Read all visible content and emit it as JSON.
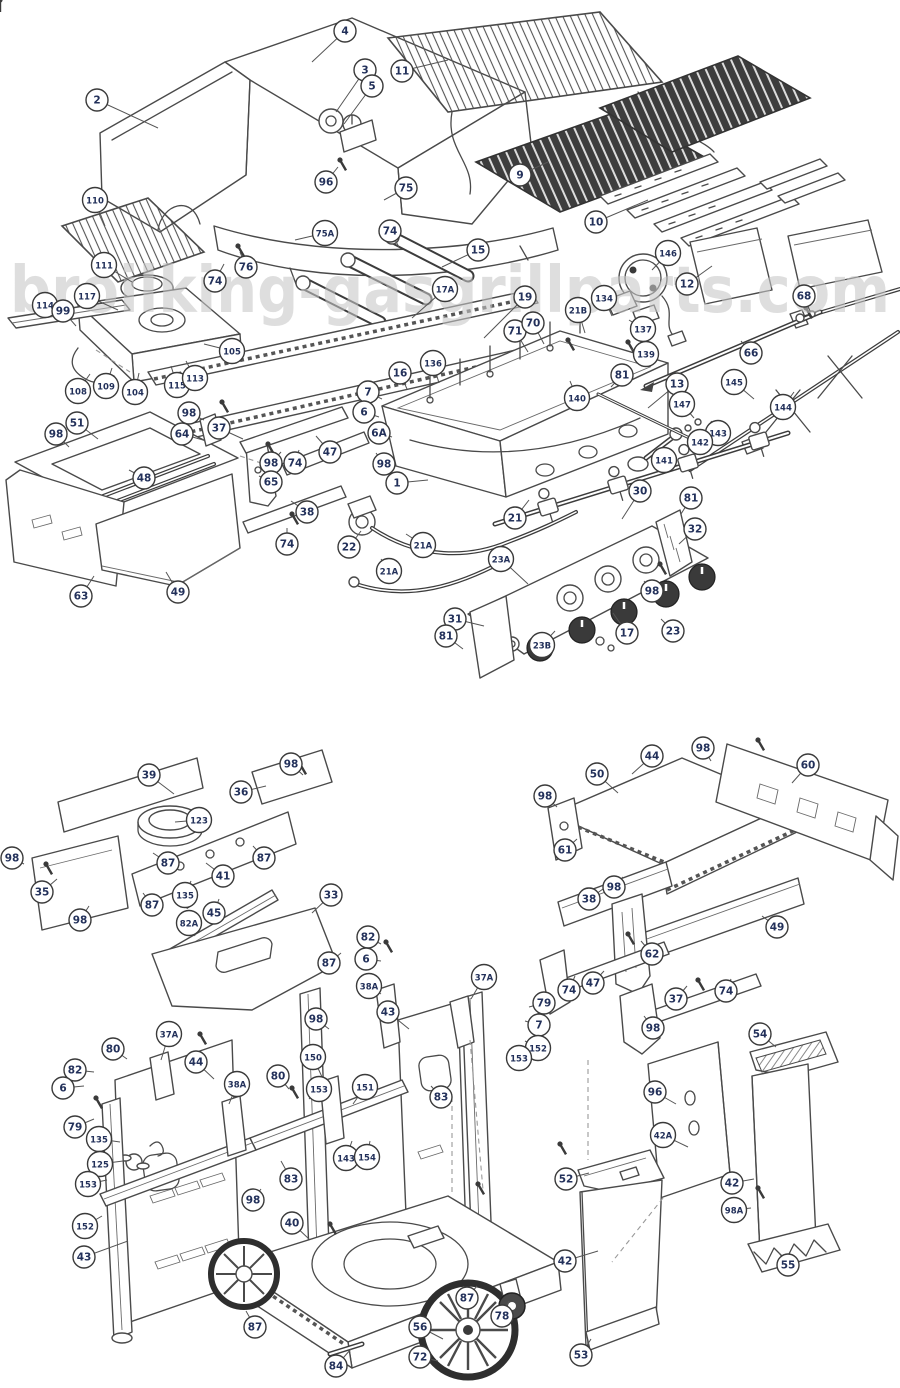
{
  "watermark": "broilking-gasgrillparts.com",
  "colors": {
    "line_art": "#4a4a4a",
    "dark_grate": "#3d3d3d",
    "balloon_number": "#22305a",
    "watermark_gray": "#c7c7c7"
  },
  "callouts": [
    {
      "n": "2",
      "x": 97,
      "y": 100,
      "tx": 158,
      "ty": 128
    },
    {
      "n": "4",
      "x": 345,
      "y": 31,
      "tx": 312,
      "ty": 62
    },
    {
      "n": "3",
      "x": 365,
      "y": 70,
      "tx": 336,
      "ty": 112
    },
    {
      "n": "5",
      "x": 372,
      "y": 86,
      "tx": 344,
      "ty": 124
    },
    {
      "n": "96",
      "x": 326,
      "y": 182,
      "tx": 338,
      "ty": 167
    },
    {
      "n": "75",
      "x": 406,
      "y": 188,
      "tx": 384,
      "ty": 200
    },
    {
      "n": "75A",
      "x": 325,
      "y": 233,
      "tx": 295,
      "ty": 240
    },
    {
      "n": "11",
      "x": 402,
      "y": 71,
      "tx": 448,
      "ty": 60
    },
    {
      "n": "9",
      "x": 520,
      "y": 175,
      "tx": 548,
      "ty": 162
    },
    {
      "n": "10",
      "x": 596,
      "y": 222,
      "tx": 648,
      "ty": 200
    },
    {
      "n": "110",
      "x": 95,
      "y": 200,
      "tx": 105,
      "ty": 226
    },
    {
      "n": "111",
      "x": 104,
      "y": 265,
      "tx": 132,
      "ty": 282
    },
    {
      "n": "74",
      "x": 215,
      "y": 281,
      "tx": 224,
      "ty": 264
    },
    {
      "n": "76",
      "x": 246,
      "y": 267,
      "tx": 240,
      "ty": 252
    },
    {
      "n": "117",
      "x": 87,
      "y": 296,
      "tx": 118,
      "ty": 310
    },
    {
      "n": "114",
      "x": 45,
      "y": 305,
      "tx": 60,
      "ty": 320
    },
    {
      "n": "99",
      "x": 63,
      "y": 311,
      "tx": 76,
      "ty": 326
    },
    {
      "n": "105",
      "x": 232,
      "y": 351,
      "tx": 204,
      "ty": 344
    },
    {
      "n": "108",
      "x": 78,
      "y": 391,
      "tx": 90,
      "ty": 374
    },
    {
      "n": "109",
      "x": 106,
      "y": 386,
      "tx": 112,
      "ty": 368
    },
    {
      "n": "104",
      "x": 135,
      "y": 392,
      "tx": 139,
      "ty": 373
    },
    {
      "n": "115",
      "x": 177,
      "y": 385,
      "tx": 171,
      "ty": 366
    },
    {
      "n": "113",
      "x": 195,
      "y": 378,
      "tx": 186,
      "ty": 361
    },
    {
      "n": "74",
      "x": 390,
      "y": 231,
      "tx": 399,
      "ty": 247
    },
    {
      "n": "15",
      "x": 478,
      "y": 250,
      "tx": 442,
      "ty": 267
    },
    {
      "n": "17A",
      "x": 445,
      "y": 289,
      "tx": 412,
      "ty": 318
    },
    {
      "n": "19",
      "x": 525,
      "y": 297,
      "tx": 484,
      "ty": 338
    },
    {
      "n": "71",
      "x": 515,
      "y": 331,
      "tx": 528,
      "ty": 352
    },
    {
      "n": "70",
      "x": 533,
      "y": 323,
      "tx": 544,
      "ty": 344
    },
    {
      "n": "21B",
      "x": 578,
      "y": 310,
      "tx": 585,
      "ty": 333
    },
    {
      "n": "134",
      "x": 604,
      "y": 298,
      "tx": 612,
      "ty": 316
    },
    {
      "n": "146",
      "x": 668,
      "y": 253,
      "tx": 652,
      "ty": 270
    },
    {
      "n": "12",
      "x": 687,
      "y": 284,
      "tx": 712,
      "ty": 266
    },
    {
      "n": "68",
      "x": 804,
      "y": 296,
      "tx": 810,
      "ty": 311
    },
    {
      "n": "137",
      "x": 643,
      "y": 329,
      "tx": 629,
      "ty": 320
    },
    {
      "n": "139",
      "x": 646,
      "y": 354,
      "tx": 631,
      "ty": 349
    },
    {
      "n": "81",
      "x": 622,
      "y": 375,
      "tx": 611,
      "ty": 387
    },
    {
      "n": "66",
      "x": 751,
      "y": 353,
      "tx": 741,
      "ty": 341
    },
    {
      "n": "13",
      "x": 677,
      "y": 384,
      "tx": 648,
      "ty": 408
    },
    {
      "n": "145",
      "x": 734,
      "y": 382,
      "tx": 754,
      "ty": 399
    },
    {
      "n": "147",
      "x": 682,
      "y": 404,
      "tx": 694,
      "ty": 418
    },
    {
      "n": "144",
      "x": 783,
      "y": 407,
      "tx": 794,
      "ty": 392
    },
    {
      "n": "143",
      "x": 718,
      "y": 433,
      "tx": 711,
      "ty": 421
    },
    {
      "n": "142",
      "x": 700,
      "y": 442,
      "tx": 690,
      "ty": 433
    },
    {
      "n": "141",
      "x": 664,
      "y": 460,
      "tx": 656,
      "ty": 449
    },
    {
      "n": "140",
      "x": 577,
      "y": 398,
      "tx": 570,
      "ty": 381
    },
    {
      "n": "16",
      "x": 400,
      "y": 373,
      "tx": 407,
      "ty": 389
    },
    {
      "n": "136",
      "x": 433,
      "y": 363,
      "tx": 439,
      "ty": 383
    },
    {
      "n": "7",
      "x": 368,
      "y": 392,
      "tx": 382,
      "ty": 399
    },
    {
      "n": "6",
      "x": 364,
      "y": 412,
      "tx": 379,
      "ty": 417
    },
    {
      "n": "6A",
      "x": 379,
      "y": 433,
      "tx": 392,
      "ty": 437
    },
    {
      "n": "1",
      "x": 397,
      "y": 483,
      "tx": 428,
      "ty": 480
    },
    {
      "n": "98",
      "x": 189,
      "y": 413,
      "tx": 204,
      "ty": 420
    },
    {
      "n": "64",
      "x": 182,
      "y": 434,
      "tx": 203,
      "ty": 440
    },
    {
      "n": "51",
      "x": 77,
      "y": 423,
      "tx": 98,
      "ty": 439
    },
    {
      "n": "98",
      "x": 56,
      "y": 434,
      "tx": 69,
      "ty": 447
    },
    {
      "n": "37",
      "x": 219,
      "y": 428,
      "tx": 243,
      "ty": 439
    },
    {
      "n": "98",
      "x": 271,
      "y": 463,
      "tx": 281,
      "ty": 452
    },
    {
      "n": "74",
      "x": 295,
      "y": 463,
      "tx": 299,
      "ty": 450
    },
    {
      "n": "65",
      "x": 271,
      "y": 482,
      "tx": 259,
      "ty": 476
    },
    {
      "n": "48",
      "x": 144,
      "y": 478,
      "tx": 129,
      "ty": 470
    },
    {
      "n": "63",
      "x": 81,
      "y": 596,
      "tx": 94,
      "ty": 576
    },
    {
      "n": "49",
      "x": 178,
      "y": 592,
      "tx": 166,
      "ty": 572
    },
    {
      "n": "47",
      "x": 330,
      "y": 452,
      "tx": 316,
      "ty": 436
    },
    {
      "n": "98",
      "x": 384,
      "y": 464,
      "tx": 376,
      "ty": 453
    },
    {
      "n": "38",
      "x": 307,
      "y": 512,
      "tx": 291,
      "ty": 501
    },
    {
      "n": "74",
      "x": 287,
      "y": 544,
      "tx": 287,
      "ty": 528
    },
    {
      "n": "22",
      "x": 349,
      "y": 547,
      "tx": 361,
      "ty": 531
    },
    {
      "n": "21A",
      "x": 423,
      "y": 545,
      "tx": 406,
      "ty": 534
    },
    {
      "n": "21A",
      "x": 389,
      "y": 571,
      "tx": 381,
      "ty": 559
    },
    {
      "n": "21",
      "x": 515,
      "y": 518,
      "tx": 529,
      "ty": 500
    },
    {
      "n": "23A",
      "x": 501,
      "y": 559,
      "tx": 528,
      "ty": 584
    },
    {
      "n": "30",
      "x": 640,
      "y": 491,
      "tx": 622,
      "ty": 519
    },
    {
      "n": "81",
      "x": 691,
      "y": 498,
      "tx": 681,
      "ty": 514
    },
    {
      "n": "32",
      "x": 695,
      "y": 529,
      "tx": 679,
      "ty": 544
    },
    {
      "n": "98",
      "x": 652,
      "y": 591,
      "tx": 644,
      "ty": 581
    },
    {
      "n": "23",
      "x": 673,
      "y": 631,
      "tx": 661,
      "ty": 619
    },
    {
      "n": "17",
      "x": 627,
      "y": 633,
      "tx": 613,
      "ty": 613
    },
    {
      "n": "23B",
      "x": 542,
      "y": 645,
      "tx": 555,
      "ty": 631
    },
    {
      "n": "31",
      "x": 455,
      "y": 619,
      "tx": 484,
      "ty": 626
    },
    {
      "n": "81",
      "x": 446,
      "y": 636,
      "tx": 463,
      "ty": 649
    },
    {
      "n": "39",
      "x": 149,
      "y": 775,
      "tx": 174,
      "ty": 794
    },
    {
      "n": "98",
      "x": 291,
      "y": 764,
      "tx": 303,
      "ty": 775
    },
    {
      "n": "36",
      "x": 241,
      "y": 792,
      "tx": 266,
      "ty": 786
    },
    {
      "n": "123",
      "x": 199,
      "y": 820,
      "tx": 175,
      "ty": 822
    },
    {
      "n": "87",
      "x": 264,
      "y": 858,
      "tx": 253,
      "ty": 846
    },
    {
      "n": "41",
      "x": 223,
      "y": 876,
      "tx": 206,
      "ty": 863
    },
    {
      "n": "87",
      "x": 168,
      "y": 863,
      "tx": 153,
      "ty": 853
    },
    {
      "n": "35",
      "x": 42,
      "y": 892,
      "tx": 57,
      "ty": 879
    },
    {
      "n": "98",
      "x": 80,
      "y": 920,
      "tx": 89,
      "ty": 906
    },
    {
      "n": "87",
      "x": 152,
      "y": 905,
      "tx": 143,
      "ty": 893
    },
    {
      "n": "135",
      "x": 185,
      "y": 895,
      "tx": 191,
      "ty": 881
    },
    {
      "n": "45",
      "x": 214,
      "y": 913,
      "tx": 219,
      "ty": 899
    },
    {
      "n": "82A",
      "x": 189,
      "y": 923,
      "tx": 195,
      "ty": 936
    },
    {
      "n": "33",
      "x": 331,
      "y": 895,
      "tx": 312,
      "ty": 913
    },
    {
      "n": "98",
      "x": 12,
      "y": 858,
      "tx": 24,
      "ty": 864
    },
    {
      "n": "44",
      "x": 652,
      "y": 756,
      "tx": 632,
      "ty": 774
    },
    {
      "n": "50",
      "x": 597,
      "y": 774,
      "tx": 618,
      "ty": 793
    },
    {
      "n": "98",
      "x": 545,
      "y": 796,
      "tx": 557,
      "ty": 807
    },
    {
      "n": "98",
      "x": 703,
      "y": 748,
      "tx": 711,
      "ty": 761
    },
    {
      "n": "60",
      "x": 808,
      "y": 765,
      "tx": 792,
      "ty": 783
    },
    {
      "n": "61",
      "x": 565,
      "y": 850,
      "tx": 577,
      "ty": 839
    },
    {
      "n": "38",
      "x": 589,
      "y": 899,
      "tx": 603,
      "ty": 889
    },
    {
      "n": "98",
      "x": 614,
      "y": 887,
      "tx": 623,
      "ty": 877
    },
    {
      "n": "49",
      "x": 777,
      "y": 927,
      "tx": 762,
      "ty": 916
    },
    {
      "n": "62",
      "x": 652,
      "y": 954,
      "tx": 641,
      "ty": 941
    },
    {
      "n": "47",
      "x": 593,
      "y": 983,
      "tx": 604,
      "ty": 971
    },
    {
      "n": "74",
      "x": 569,
      "y": 990,
      "tx": 575,
      "ty": 976
    },
    {
      "n": "37",
      "x": 676,
      "y": 999,
      "tx": 687,
      "ty": 986
    },
    {
      "n": "74",
      "x": 726,
      "y": 991,
      "tx": 731,
      "ty": 979
    },
    {
      "n": "98",
      "x": 653,
      "y": 1028,
      "tx": 644,
      "ty": 1016
    },
    {
      "n": "54",
      "x": 760,
      "y": 1034,
      "tx": 776,
      "ty": 1047
    },
    {
      "n": "96",
      "x": 655,
      "y": 1092,
      "tx": 676,
      "ty": 1104
    },
    {
      "n": "42A",
      "x": 663,
      "y": 1135,
      "tx": 688,
      "ty": 1147
    },
    {
      "n": "42",
      "x": 732,
      "y": 1183,
      "tx": 754,
      "ty": 1179
    },
    {
      "n": "98A",
      "x": 734,
      "y": 1210,
      "tx": 751,
      "ty": 1208
    },
    {
      "n": "55",
      "x": 788,
      "y": 1265,
      "tx": 779,
      "ty": 1253
    },
    {
      "n": "52",
      "x": 566,
      "y": 1179,
      "tx": 589,
      "ty": 1173
    },
    {
      "n": "42",
      "x": 565,
      "y": 1261,
      "tx": 598,
      "ty": 1251
    },
    {
      "n": "53",
      "x": 581,
      "y": 1355,
      "tx": 591,
      "ty": 1339
    },
    {
      "n": "37A",
      "x": 169,
      "y": 1034,
      "tx": 161,
      "ty": 1060
    },
    {
      "n": "80",
      "x": 113,
      "y": 1049,
      "tx": 127,
      "ty": 1059
    },
    {
      "n": "82",
      "x": 75,
      "y": 1070,
      "tx": 94,
      "ty": 1072
    },
    {
      "n": "6",
      "x": 63,
      "y": 1088,
      "tx": 84,
      "ty": 1086
    },
    {
      "n": "79",
      "x": 75,
      "y": 1127,
      "tx": 94,
      "ty": 1119
    },
    {
      "n": "135",
      "x": 99,
      "y": 1139,
      "tx": 120,
      "ty": 1142
    },
    {
      "n": "125",
      "x": 100,
      "y": 1164,
      "tx": 123,
      "ty": 1161
    },
    {
      "n": "153",
      "x": 88,
      "y": 1184,
      "tx": 107,
      "ty": 1180
    },
    {
      "n": "152",
      "x": 85,
      "y": 1226,
      "tx": 102,
      "ty": 1216
    },
    {
      "n": "43",
      "x": 84,
      "y": 1257,
      "tx": 128,
      "ty": 1241
    },
    {
      "n": "44",
      "x": 196,
      "y": 1062,
      "tx": 214,
      "ty": 1079
    },
    {
      "n": "38A",
      "x": 237,
      "y": 1084,
      "tx": 229,
      "ty": 1104
    },
    {
      "n": "80",
      "x": 278,
      "y": 1076,
      "tx": 289,
      "ty": 1089
    },
    {
      "n": "150",
      "x": 313,
      "y": 1057,
      "tx": 322,
      "ty": 1077
    },
    {
      "n": "153",
      "x": 319,
      "y": 1089,
      "tx": 309,
      "ty": 1099
    },
    {
      "n": "151",
      "x": 365,
      "y": 1087,
      "tx": 353,
      "ty": 1104
    },
    {
      "n": "98",
      "x": 316,
      "y": 1019,
      "tx": 329,
      "ty": 1029
    },
    {
      "n": "87",
      "x": 329,
      "y": 963,
      "tx": 341,
      "ty": 953
    },
    {
      "n": "82",
      "x": 368,
      "y": 937,
      "tx": 381,
      "ty": 944
    },
    {
      "n": "6",
      "x": 366,
      "y": 959,
      "tx": 381,
      "ty": 961
    },
    {
      "n": "38A",
      "x": 369,
      "y": 986,
      "tx": 381,
      "ty": 994
    },
    {
      "n": "43",
      "x": 388,
      "y": 1012,
      "tx": 409,
      "ty": 1029
    },
    {
      "n": "37A",
      "x": 484,
      "y": 977,
      "tx": 471,
      "ty": 999
    },
    {
      "n": "79",
      "x": 544,
      "y": 1003,
      "tx": 529,
      "ty": 1007
    },
    {
      "n": "7",
      "x": 539,
      "y": 1025,
      "tx": 525,
      "ty": 1021
    },
    {
      "n": "152",
      "x": 538,
      "y": 1048,
      "tx": 525,
      "ty": 1041
    },
    {
      "n": "153",
      "x": 519,
      "y": 1058,
      "tx": 509,
      "ty": 1049
    },
    {
      "n": "83",
      "x": 441,
      "y": 1097,
      "tx": 431,
      "ty": 1086
    },
    {
      "n": "143",
      "x": 346,
      "y": 1158,
      "tx": 352,
      "ty": 1141
    },
    {
      "n": "154",
      "x": 367,
      "y": 1157,
      "tx": 370,
      "ty": 1141
    },
    {
      "n": "83",
      "x": 291,
      "y": 1179,
      "tx": 281,
      "ty": 1161
    },
    {
      "n": "98",
      "x": 253,
      "y": 1200,
      "tx": 261,
      "ty": 1189
    },
    {
      "n": "40",
      "x": 292,
      "y": 1223,
      "tx": 309,
      "ty": 1239
    },
    {
      "n": "87",
      "x": 255,
      "y": 1327,
      "tx": 246,
      "ty": 1311
    },
    {
      "n": "84",
      "x": 336,
      "y": 1366,
      "tx": 351,
      "ty": 1349
    },
    {
      "n": "56",
      "x": 420,
      "y": 1327,
      "tx": 443,
      "ty": 1339
    },
    {
      "n": "72",
      "x": 420,
      "y": 1357,
      "tx": 438,
      "ty": 1361
    },
    {
      "n": "87",
      "x": 467,
      "y": 1298,
      "tx": 477,
      "ty": 1286
    },
    {
      "n": "78",
      "x": 502,
      "y": 1316,
      "tx": 509,
      "ty": 1301
    }
  ]
}
